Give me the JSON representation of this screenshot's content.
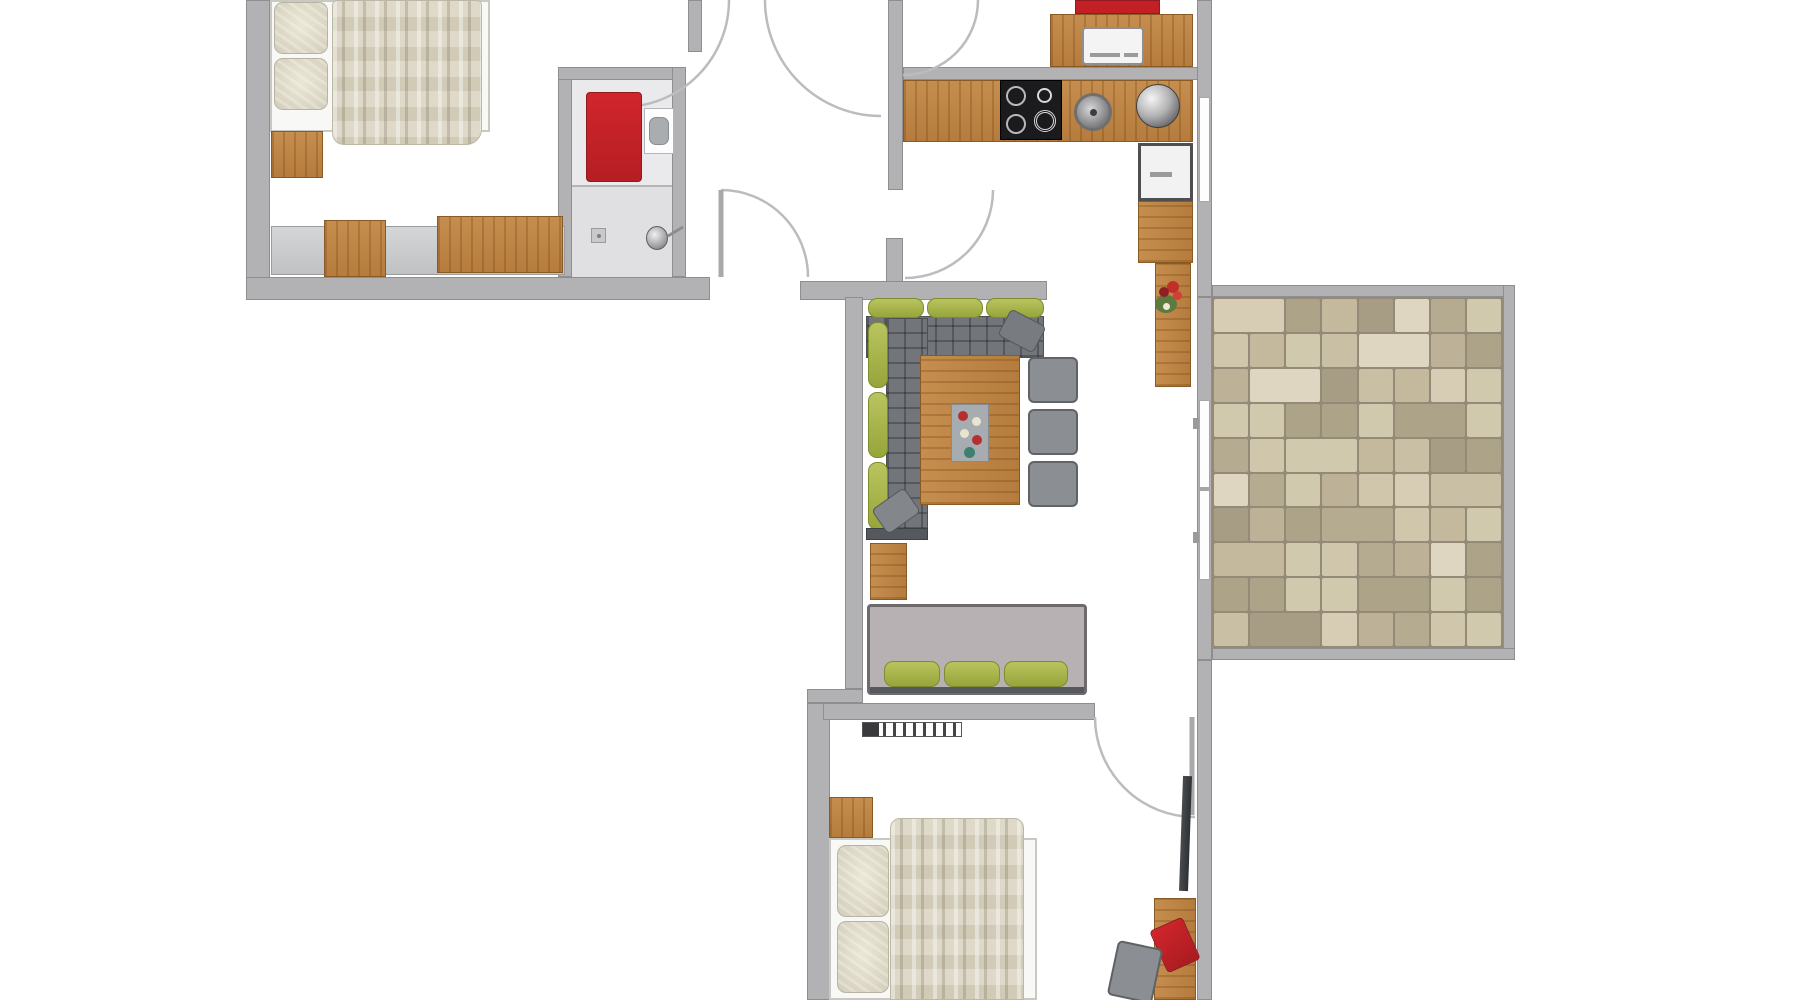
{
  "meta": {
    "type": "apartment-floor-plan",
    "view": "top-down",
    "visible_text_labels": []
  },
  "palette": {
    "wall_gray": "#b2b2b4",
    "wood": "#bf8747",
    "accent_red": "#c32026",
    "cushion_green": "#a9b74b",
    "sofa_gray": "#72767b",
    "loveseat_gray": "#b8b1b3",
    "bed_linen": "#f8f8f6",
    "blanket_beige": "#d9d4c0",
    "bathroom_floor": "#eaeaec",
    "cooktop_black": "#1b1b1d",
    "floor_white": "#ffffff",
    "terrace_tile_colors": [
      "#d6cdb4",
      "#c4b99c",
      "#b5ab90",
      "#cfc6ac",
      "#ada389",
      "#ded6c0",
      "#bdb198",
      "#c9bfa4",
      "#a79d84",
      "#d1c9ae"
    ],
    "terrace_grout": "#938b77"
  },
  "rooms": [
    {
      "id": "bedroom-1",
      "furniture": [
        "double-bed",
        "pillows",
        "duvet",
        "nightstand",
        "sideboard",
        "desk",
        "chairs"
      ]
    },
    {
      "id": "bathroom",
      "furniture": [
        "red-cabinet",
        "toilet",
        "shower",
        "shower-head",
        "floor-drain"
      ]
    },
    {
      "id": "hallway",
      "furniture": [
        "door-swings"
      ]
    },
    {
      "id": "kitchen",
      "furniture": [
        "counter",
        "cooktop",
        "sink",
        "pot",
        "faucet",
        "dishwasher",
        "red-fridge",
        "flower-pot",
        "upper-counter-appliance"
      ]
    },
    {
      "id": "living-room",
      "furniture": [
        "corner-sofa",
        "throw-pillows",
        "dining-table",
        "table-decoration",
        "dining-chairs",
        "loveseat",
        "cabinet"
      ]
    },
    {
      "id": "bedroom-2",
      "furniture": [
        "double-bed",
        "pillows",
        "duvet",
        "nightstand",
        "radiator",
        "wall-tv",
        "desk",
        "desk-chair",
        "red-chair"
      ]
    },
    {
      "id": "terrace",
      "furniture": [
        "stone-tile-floor",
        "sliding-glass-door"
      ]
    }
  ]
}
